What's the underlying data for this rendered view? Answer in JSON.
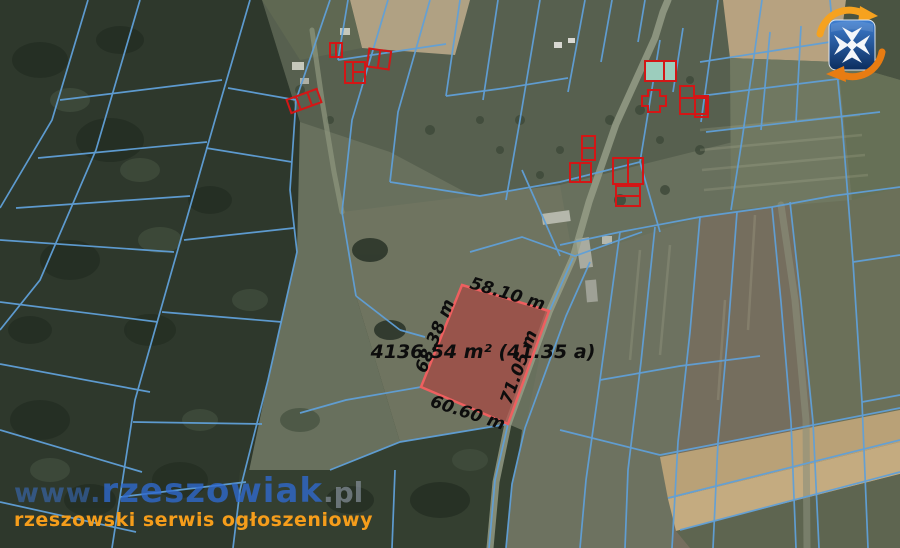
{
  "parcel": {
    "area": "4136.54 m² (41.35 a)",
    "sides": {
      "top": "58.10 m",
      "left": "68.38 m",
      "right": "71.05 m",
      "bottom": "60.60 m"
    }
  },
  "watermark": {
    "prefix": "www.",
    "name": "rzeszowiak",
    "tld": ".pl",
    "tagline": "rzeszowski serwis ogłoszeniowy"
  },
  "logo": {
    "icon": "rzeszowiak-maltese-cross-logo"
  },
  "colors": {
    "boundary-blue": "#60a0d8",
    "parcel-fill": "#b93a3a",
    "parcel-stroke": "#ee5f5f",
    "building-red": "#d31616",
    "label-black": "#0d0d0d",
    "wm-blue": "#2f6ad0",
    "wm-www-blue": "#3a70c8",
    "wm-gray": "#8d97a3",
    "wm-orange": "#f59d1b",
    "logo-orange": "#f6a21f",
    "logo-orange-dark": "#e87c12",
    "logo-blue": "#2c67b5",
    "logo-blue-dark": "#0b2d5e"
  }
}
